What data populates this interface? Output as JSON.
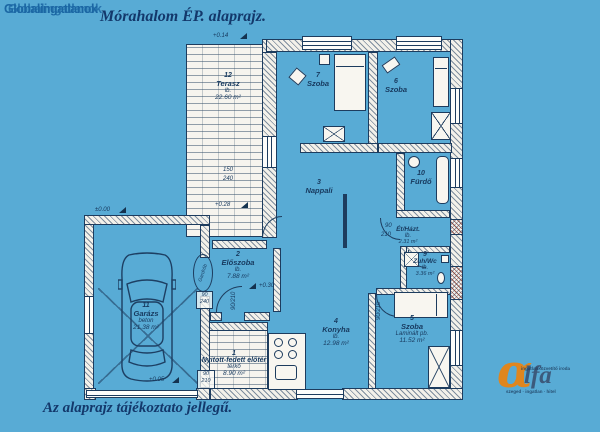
{
  "page": {
    "watermark": "Globalingatlanok",
    "title": "Mórahalom ÉP. alaprajz.",
    "caption": "Az alaprajz tájékoztato jellegű."
  },
  "logo": {
    "alpha": "α",
    "rest": "lfa",
    "line1": "ingatlanközvetítő iroda",
    "line2": "szeged · ingatlan · hitel"
  },
  "rooms": {
    "eloter": {
      "num": "1",
      "name": "Nyitott-fedett előtér",
      "mat": "térkő",
      "area": "8.90 m²"
    },
    "eloszoba": {
      "num": "2",
      "name": "Előszoba",
      "mat": "lb.",
      "area": "7.88 m²"
    },
    "nappali": {
      "num": "3",
      "name": "Nappali",
      "mat": "",
      "area": ""
    },
    "konyha": {
      "num": "4",
      "name": "Konyha",
      "mat": "lb.",
      "area": "12.98 m²"
    },
    "szoba5": {
      "num": "5",
      "name": "Szoba",
      "mat": "Laminált pb.",
      "area": "11.52 m²"
    },
    "szoba6": {
      "num": "6",
      "name": "Szoba",
      "mat": "",
      "area": ""
    },
    "szoba7": {
      "num": "7",
      "name": "Szoba",
      "mat": "",
      "area": ""
    },
    "ethazt": {
      "num": "",
      "name": "Ét/Házt.",
      "mat": "lb.",
      "area": "2.31 m²"
    },
    "zuhwc": {
      "num": "9",
      "name": "Zuh/Wc",
      "mat": "lb.",
      "area": "3.36 m²"
    },
    "furdo": {
      "num": "10",
      "name": "Fürdő",
      "mat": "",
      "area": ""
    },
    "garazs": {
      "num": "11",
      "name": "Garázs",
      "mat": "beton",
      "area": "21.38 m²"
    },
    "terasz": {
      "num": "12",
      "name": "Terasz",
      "mat": "lb.",
      "area": "22.60 m²"
    }
  },
  "levels": {
    "l014": "+0.14",
    "l028": "+0.28",
    "l000": "±0.00",
    "l030": "+0.30",
    "l005": "+0.05"
  },
  "dims": {
    "d150": "150",
    "d240": "240",
    "d90": "90",
    "d210": "210",
    "v90210": "90/210"
  },
  "misc": {
    "gardrob": "Gardrób"
  }
}
